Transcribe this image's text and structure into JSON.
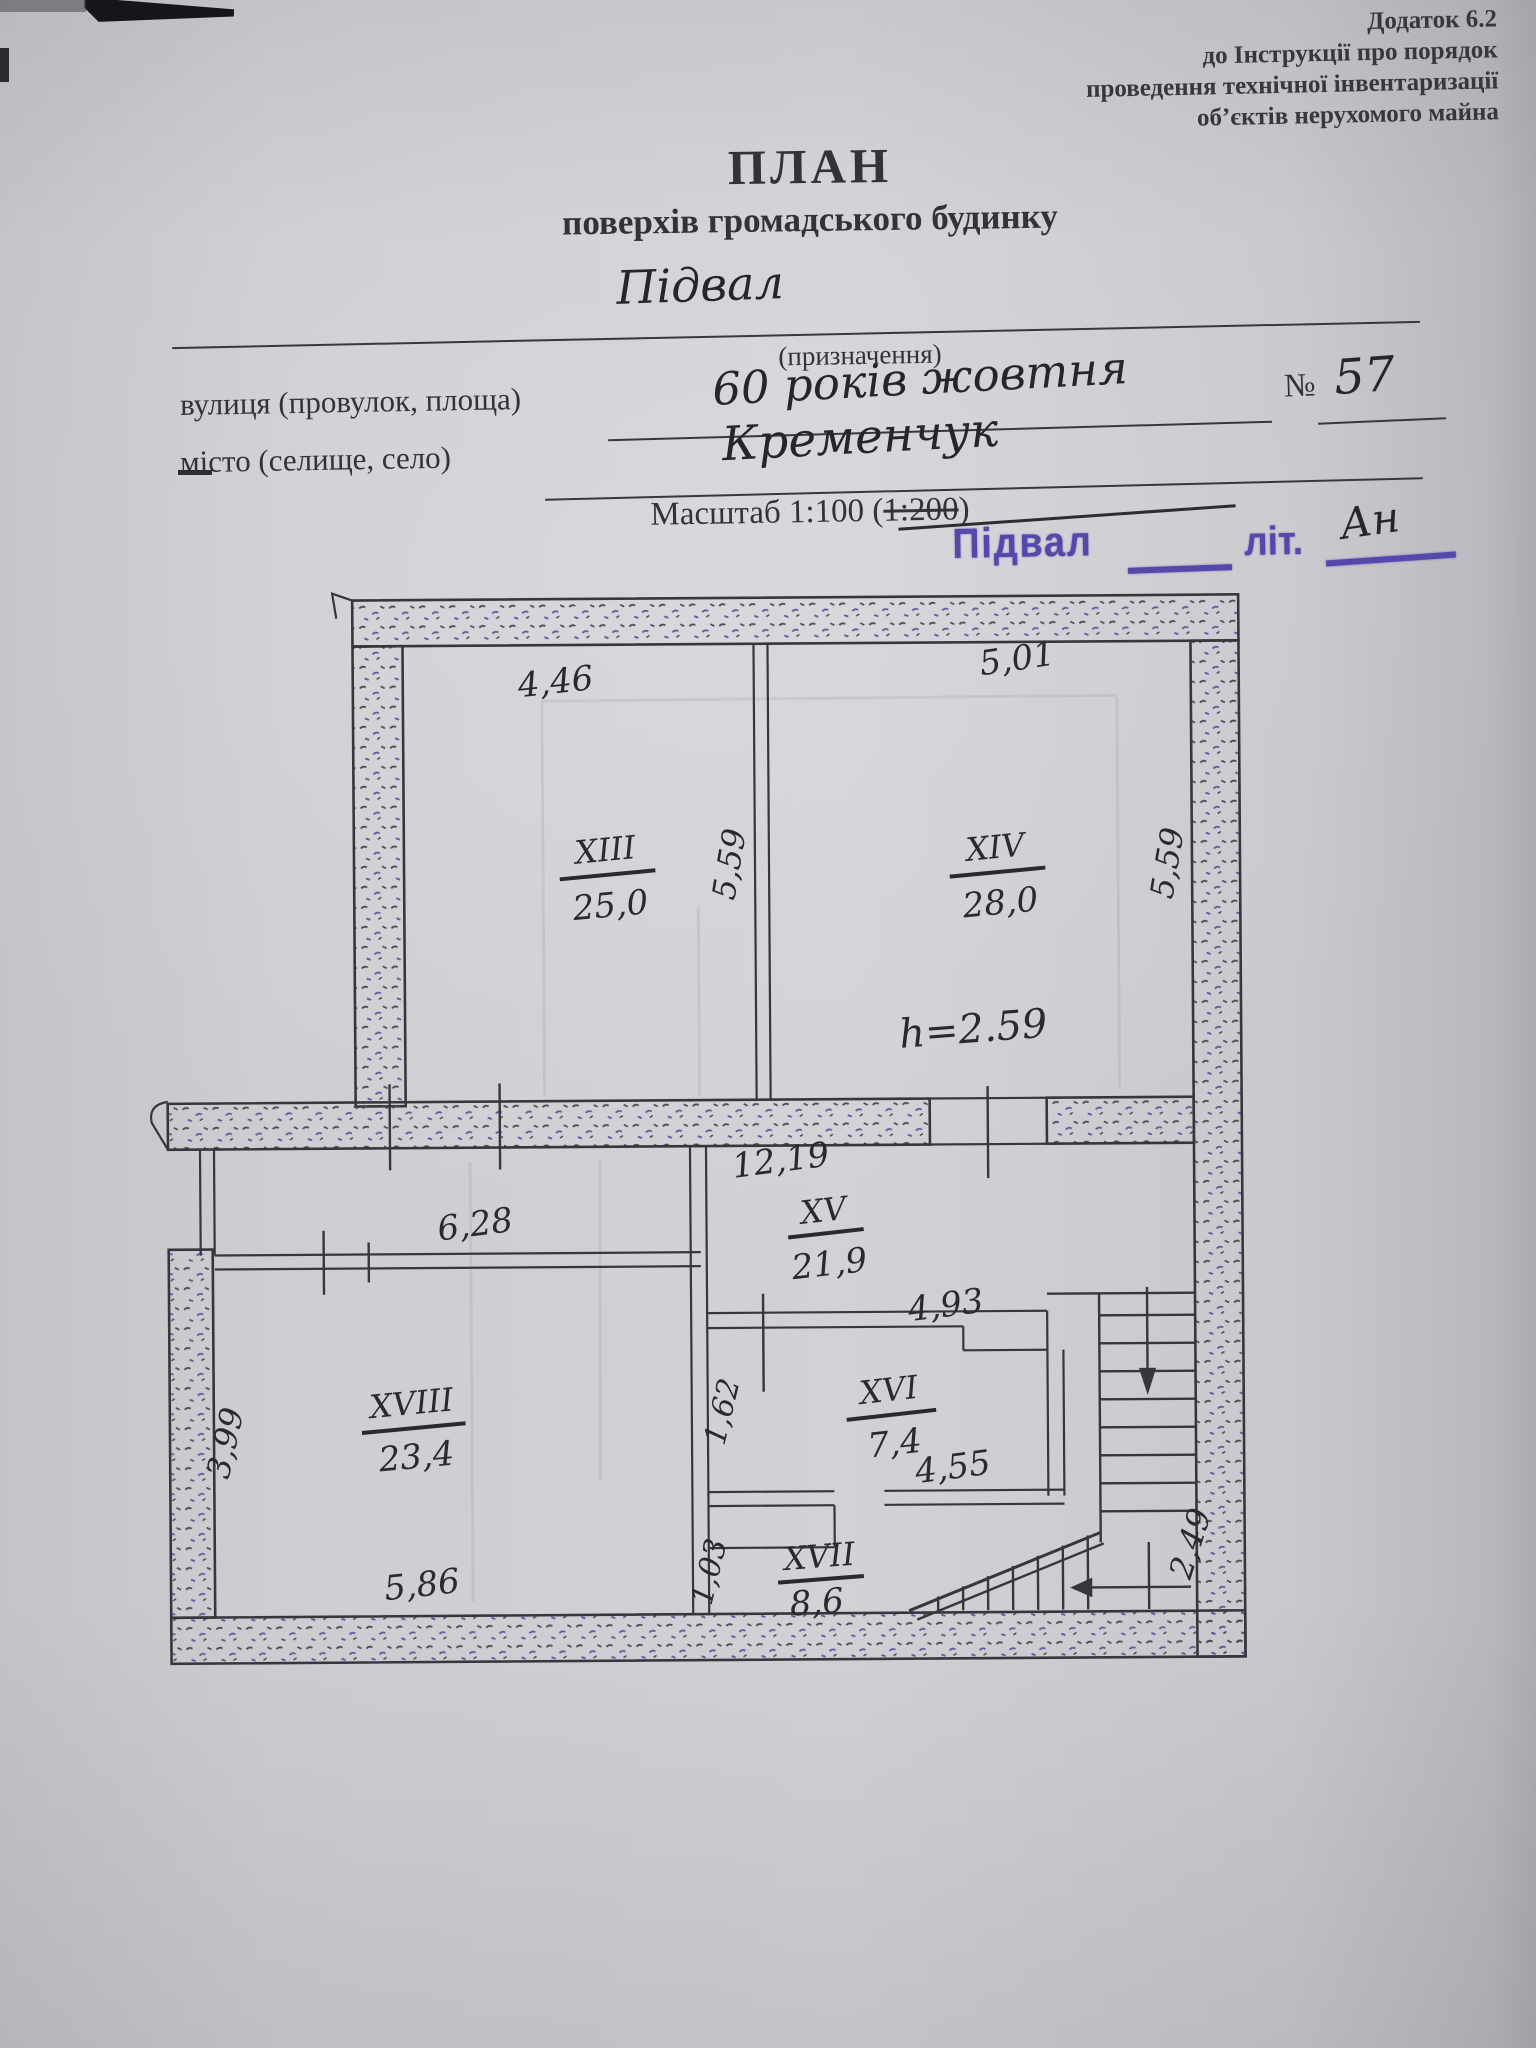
{
  "header": {
    "appendix_lines": [
      "Додаток 6.2",
      "до Інструкції про порядок",
      "проведення технічної інвентаризації",
      "об’єктів нерухомого майна"
    ],
    "title": "ПЛАН",
    "subtitle": "поверхів громадського будинку",
    "purpose_value": "Підвал",
    "purpose_caption": "(призначення)",
    "street_label": "вулиця (провулок, площа)",
    "street_value": "60 років жовтня",
    "house_no_sign": "№",
    "house_no_value": "57",
    "city_label": "місто (селище, село)",
    "city_value": "Кременчук",
    "scale_prefix": "Масштаб 1:100 (",
    "scale_struck": "1:200",
    "scale_suffix": ")"
  },
  "stamp": {
    "word": "Підвал",
    "lit_label": "літ.",
    "letter_value": "Ан"
  },
  "plan": {
    "height_note": "h=2.59",
    "rooms": [
      {
        "id": "XIII",
        "area": "25,0"
      },
      {
        "id": "XIV",
        "area": "28,0"
      },
      {
        "id": "XV",
        "area": "21,9"
      },
      {
        "id": "XVI",
        "area": "7,4"
      },
      {
        "id": "XVII",
        "area": "8,6"
      },
      {
        "id": "XVIII",
        "area": "23,4"
      }
    ],
    "dims": {
      "upper_left_width": "4,46",
      "upper_right_width": "5,01",
      "upper_mid_depth": "5,59",
      "upper_right_depth": "5,59",
      "corridor_width": "12,19",
      "xviii_top_width": "6,28",
      "xvi_top_width": "4,93",
      "xvi_bottom_width": "4,55",
      "xvi_left_depth": "1,62",
      "xvii_left_depth": "1,03",
      "xviii_left_depth": "3,99",
      "xviii_bottom_width": "5,86",
      "stairs_depth": "2,49"
    }
  }
}
